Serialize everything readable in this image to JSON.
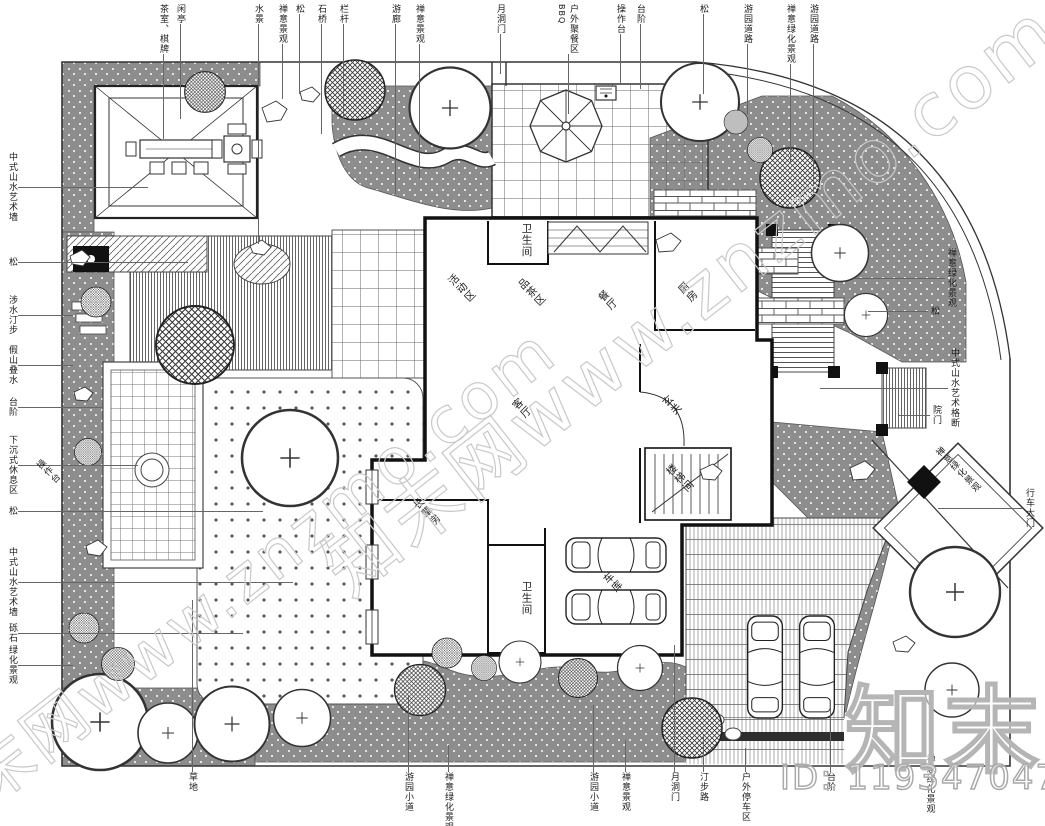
{
  "watermarks": {
    "diagonal": "知末网www.znzmo.com",
    "brand": "知末",
    "id_text": "ID: 1193470474"
  },
  "colors": {
    "ink": "#333333",
    "wall": "#111111",
    "planting": "#8d8d8d",
    "watermark": "#c9c9c9"
  },
  "annotations": {
    "top": [
      {
        "label": "茶室、棋牌"
      },
      {
        "label": "闲亭"
      },
      {
        "label": "水景"
      },
      {
        "label": "禅意景观"
      },
      {
        "label": "松"
      },
      {
        "label": "石桥"
      },
      {
        "label": "栏杆"
      },
      {
        "label": "游廊"
      },
      {
        "label": "禅意景观"
      },
      {
        "label": "月洞门"
      },
      {
        "label": "户外聚餐区",
        "sub": "BBQ"
      },
      {
        "label": "操作台"
      },
      {
        "label": "台阶"
      },
      {
        "label": "松"
      },
      {
        "label": "游园道路"
      },
      {
        "label": "禅意绿化景观"
      },
      {
        "label": "游园道路"
      }
    ],
    "left": [
      {
        "label": "中式山水艺术墙"
      },
      {
        "label": "松"
      },
      {
        "label": "涉水汀步"
      },
      {
        "label": "假山叠水"
      },
      {
        "label": "台阶"
      },
      {
        "label": "下沉式休息区"
      },
      {
        "label": "松"
      },
      {
        "label": "中式山水艺术墙"
      },
      {
        "label": "砾石"
      },
      {
        "label": "绿化景观"
      },
      {
        "label": "操作台"
      }
    ],
    "right": [
      {
        "label": "禅意绿化景观"
      },
      {
        "label": "松"
      },
      {
        "label": "中式山水艺术格断"
      },
      {
        "label": "院门"
      },
      {
        "label": "禅意绿化景观"
      },
      {
        "label": "行车大门"
      },
      {
        "label": "禅意绿化景观"
      }
    ],
    "bottom": [
      {
        "label": "草地"
      },
      {
        "label": "游园小道"
      },
      {
        "label": "禅意绿化景观"
      },
      {
        "label": "游园小道"
      },
      {
        "label": "禅意景观"
      },
      {
        "label": "月洞门"
      },
      {
        "label": "汀步路"
      },
      {
        "label": "户外停车区"
      },
      {
        "label": "台阶"
      }
    ],
    "rooms": [
      {
        "label": "卫生间"
      },
      {
        "label": "活动区"
      },
      {
        "label": "品茶区"
      },
      {
        "label": "餐厅"
      },
      {
        "label": "厨房"
      },
      {
        "label": "客厅"
      },
      {
        "label": "玄关"
      },
      {
        "label": "楼梯间"
      },
      {
        "label": "长辈房"
      },
      {
        "label": "卫生间"
      },
      {
        "label": "车库"
      }
    ]
  }
}
